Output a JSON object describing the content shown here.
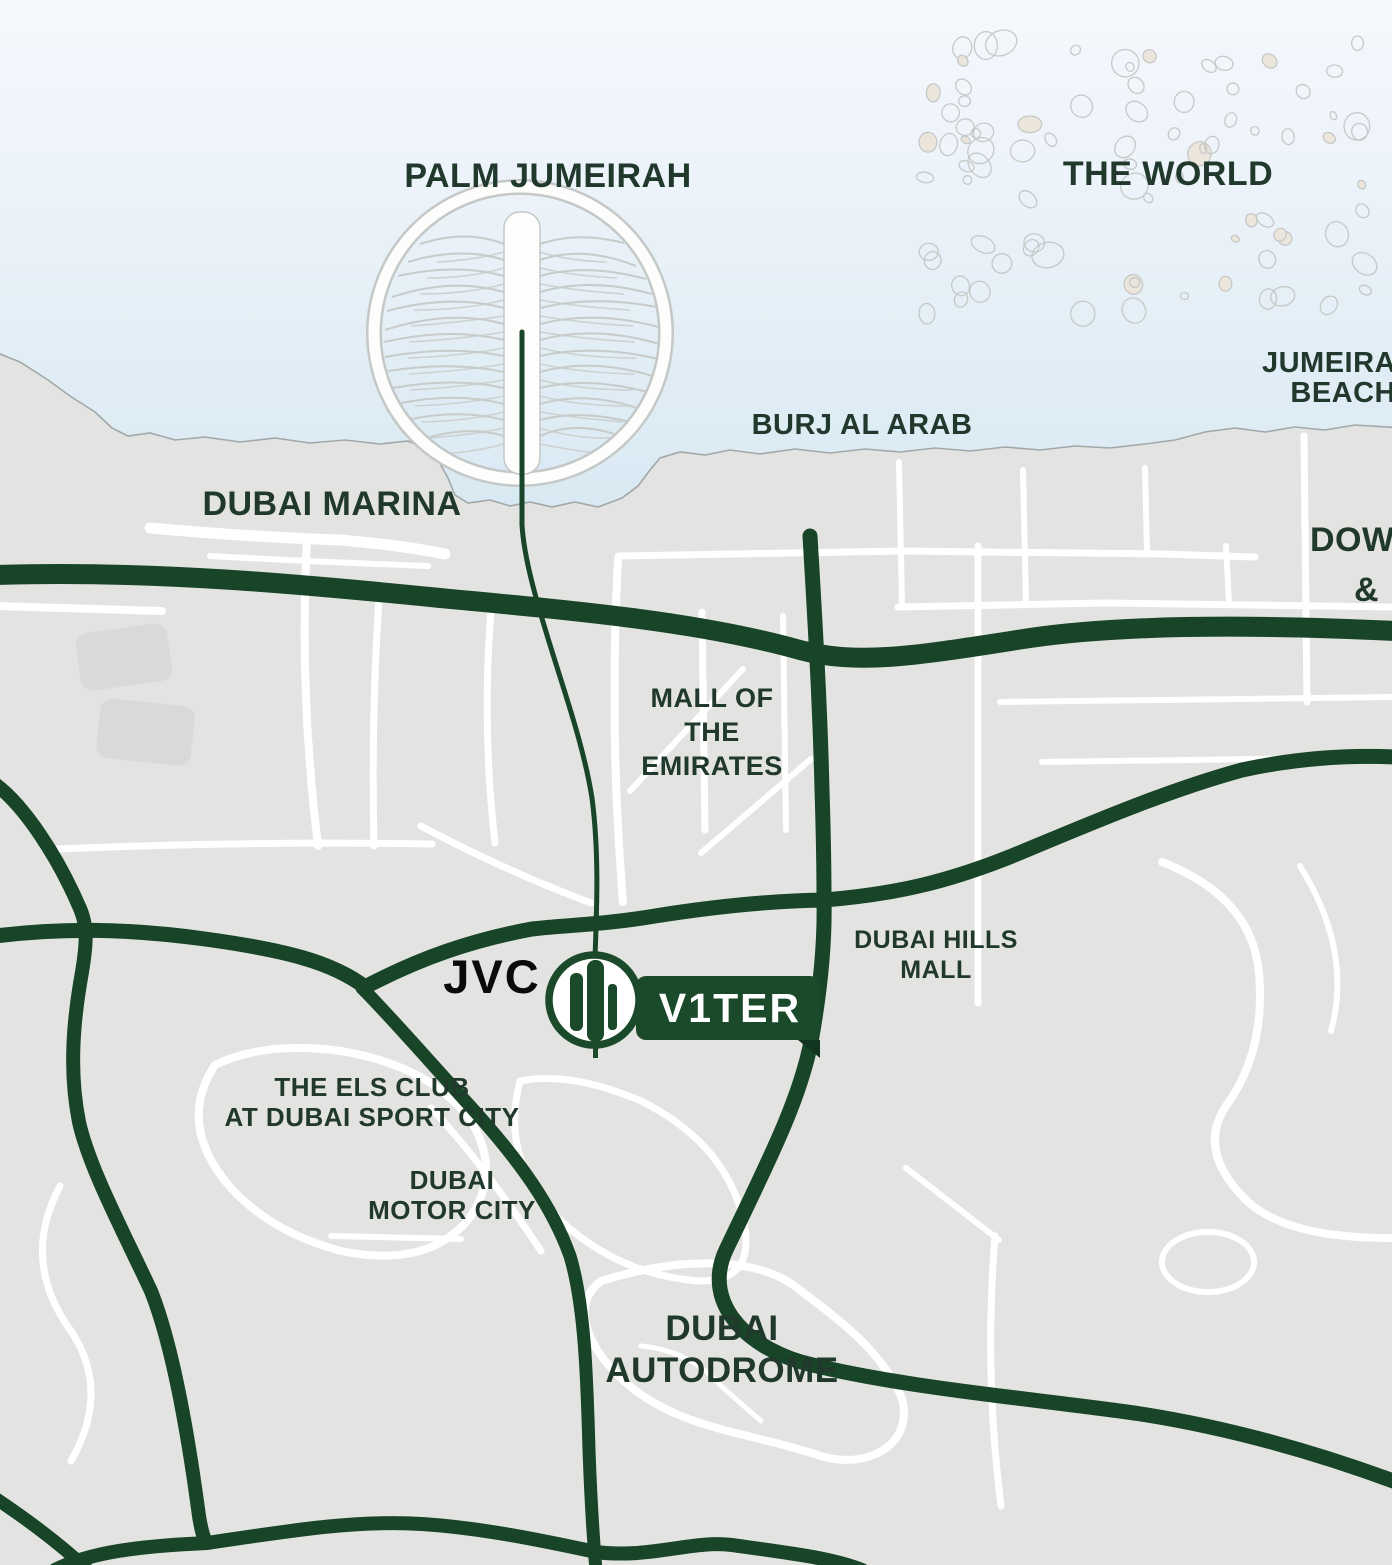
{
  "map": {
    "title": "Dubai location map",
    "labels": {
      "palm_jumeirah": "PALM JUMEIRAH",
      "the_world": "THE WORLD",
      "jumeira_beach_line1": "JUMEIRA",
      "jumeira_beach_line2": "BEACH",
      "burj_al_arab": "BURJ AL ARAB",
      "dubai_marina": "DUBAI MARINA",
      "downtown_line1": "DOW",
      "downtown_line2": "&",
      "mall_of_emirates_line1": "MALL OF",
      "mall_of_emirates_line2": "THE",
      "mall_of_emirates_line3": "EMIRATES",
      "dubai_hills_line1": "DUBAI HILLS",
      "dubai_hills_line2": "MALL",
      "jvc": "JVC",
      "els_club_line1": "THE ELS CLUB",
      "els_club_line2": "AT DUBAI SPORT CITY",
      "motor_city_line1": "DUBAI",
      "motor_city_line2": "MOTOR CITY",
      "autodrome_line1": "DUBAI",
      "autodrome_line2": "AUTODROME"
    },
    "marker": {
      "label": "V1TER",
      "area": "JVC"
    },
    "colors": {
      "road_green": "#184428",
      "badge_green": "#1b4a2b",
      "label_green": "#21392c",
      "land_gray": "#e3e3e1",
      "sea_top": "#f5f8fd",
      "sea_bottom": "#d6e8f2",
      "white_road": "#ffffff"
    }
  }
}
